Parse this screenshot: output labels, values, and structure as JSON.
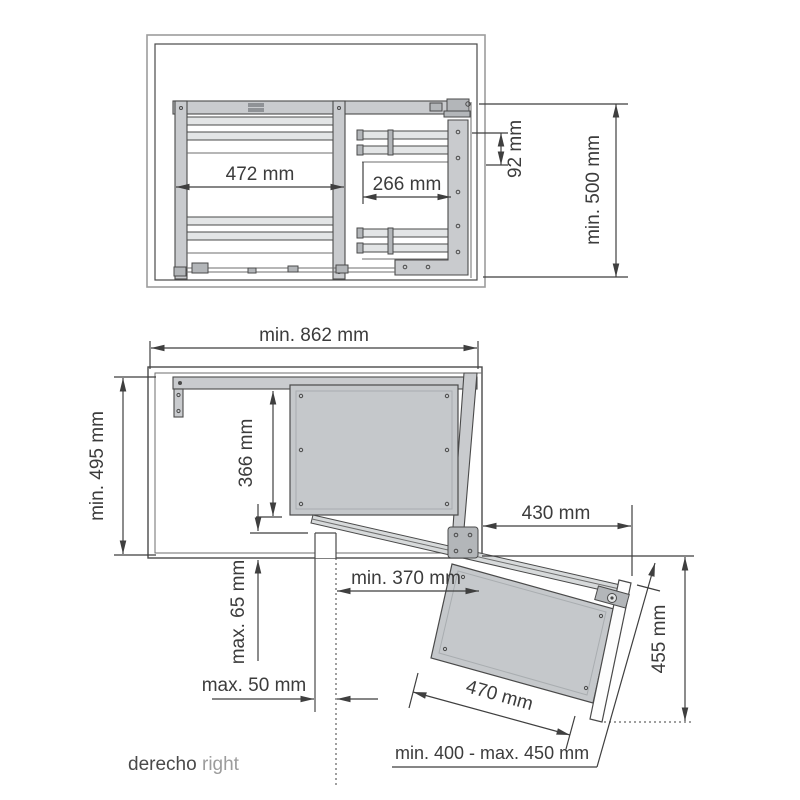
{
  "drawing": {
    "type": "corner-cabinet-pullout-mechanism-technical-drawing",
    "caption": {
      "primary": "derecho",
      "secondary": "right"
    },
    "top_view": {
      "dims": {
        "left_basket_width": "472 mm",
        "door_basket_width": "266 mm",
        "rail_spacing": "92 mm",
        "cabinet_depth": "min. 500 mm"
      }
    },
    "front_view": {
      "dims": {
        "cabinet_width": "min. 862 mm",
        "cabinet_height": "min. 495 mm",
        "panel_height": "366 mm",
        "door_projection": "430 mm",
        "opening_clearance": "min. 370 mm",
        "bottom_gap": "max. 65 mm",
        "side_gap": "max. 50 mm",
        "tray_width": "470 mm",
        "door_drop": "455 mm",
        "door_width_range": "min. 400 - max. 450 mm"
      }
    },
    "colors": {
      "line": "#4a4a4a",
      "dim_line": "#3f3f3f",
      "wall_light": "#9d9d9d",
      "metal_fill": "#c9cbce",
      "metal_dark": "#b3b6b9",
      "panel_fill": "#c5c8cb",
      "door_fill": "#fdfdfd",
      "text": "#3c3c3c",
      "caption_secondary": "#9c9c9c"
    }
  }
}
